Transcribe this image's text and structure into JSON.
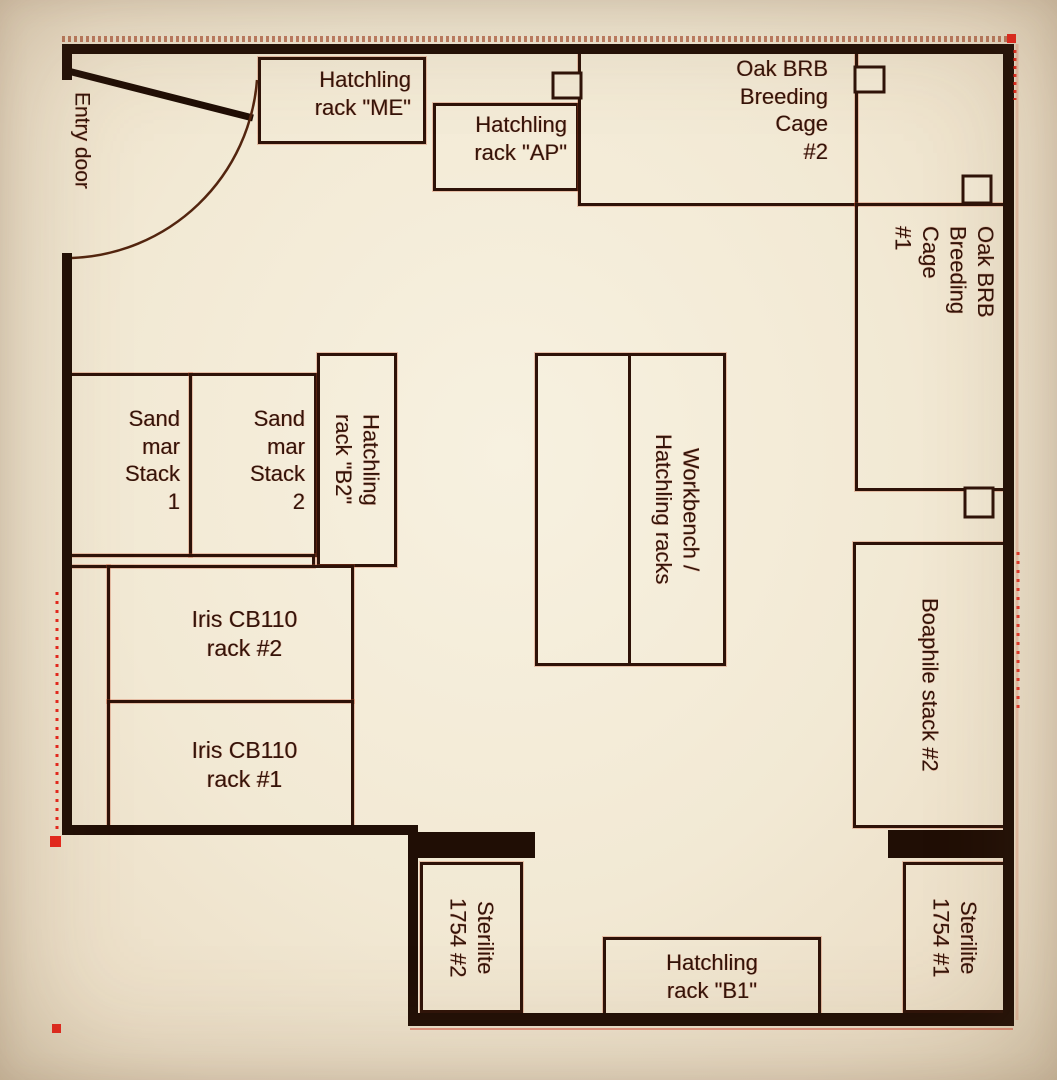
{
  "palette": {
    "paper": "#f2e9d4",
    "wall": "#200e05",
    "line": "#2e1208",
    "text": "#33140a",
    "red-mark": "#e8271d"
  },
  "plan": {
    "entry_door_label": "Entry door",
    "rooms": {
      "hatchling_me": "Hatchling\nrack \"ME\"",
      "hatchling_ap": "Hatchling\nrack \"AP\"",
      "oak_brb_cage_2": "Oak BRB\nBreeding\nCage\n#2",
      "oak_brb_cage_1": "Oak BRB\nBreeding\nCage\n#1",
      "sand_mar_stack_1": "Sand\nmar\nStack\n1",
      "sand_mar_stack_2": "Sand\nmar\nStack\n2",
      "hatchling_b2": "Hatchling\nrack \"B2\"",
      "workbench": "Workbench /\nHatchling racks",
      "boaphile_stack_2": "Boaphile stack #2",
      "iris_rack_2": "Iris CB110\nrack #2",
      "iris_rack_1": "Iris CB110\nrack #1",
      "sterilite_2": "Sterilite\n1754 #2",
      "sterilite_1": "Sterilite\n1754 #1",
      "hatchling_b1": "Hatchling\nrack \"B1\""
    }
  }
}
